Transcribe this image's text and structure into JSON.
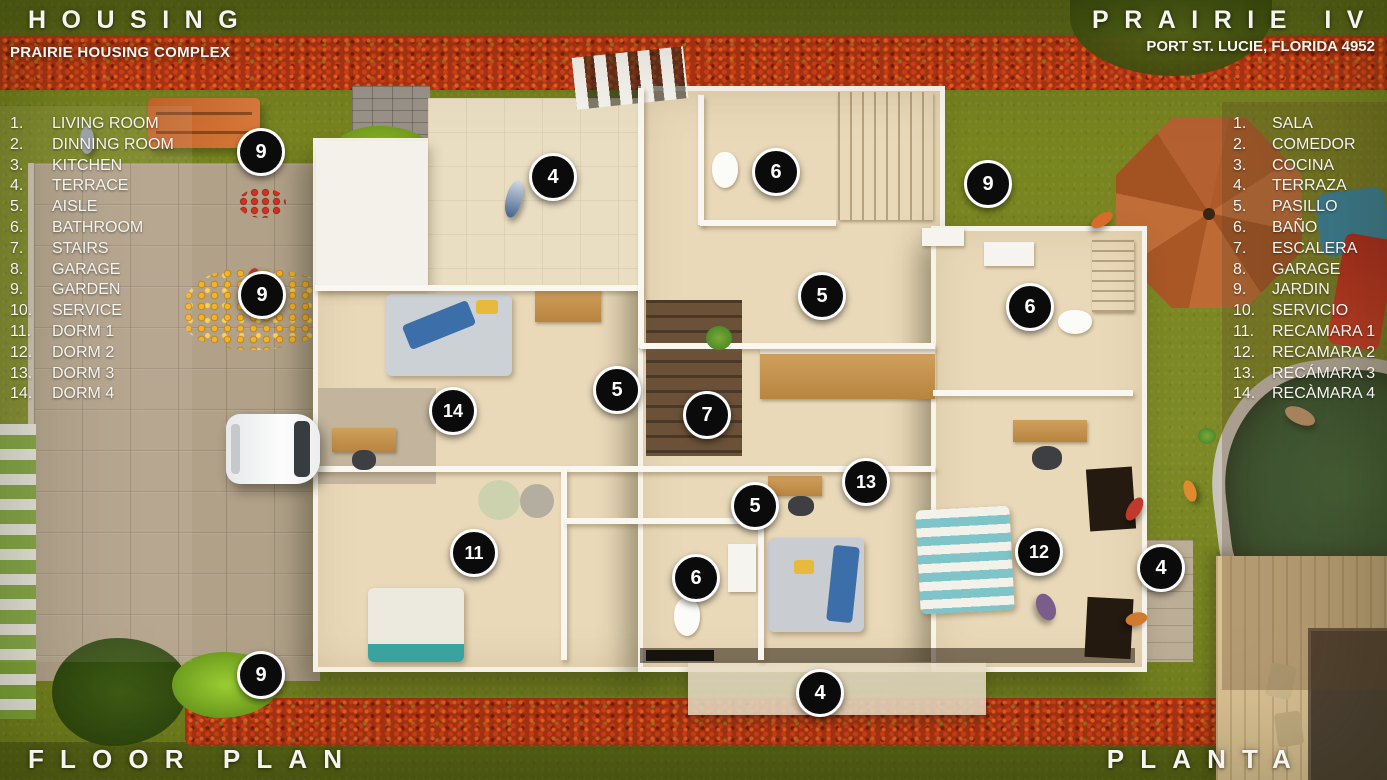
{
  "header": {
    "title_left": "HOUSING",
    "subtitle_left": "PRAIRIE HOUSING COMPLEX",
    "title_right": "PRAIRIE IV",
    "subtitle_right": "PORT ST. LUCIE, FLORIDA 4952"
  },
  "footer": {
    "label_left": "FLOOR PLAN",
    "label_right": "PLANTA"
  },
  "legend_en": {
    "items": [
      {
        "num": "1.",
        "label": "LIVING ROOM"
      },
      {
        "num": "2.",
        "label": "DINNING ROOM"
      },
      {
        "num": "3.",
        "label": "KITCHEN"
      },
      {
        "num": "4.",
        "label": "TERRACE"
      },
      {
        "num": "5.",
        "label": "AISLE"
      },
      {
        "num": "6.",
        "label": "BATHROOM"
      },
      {
        "num": "7.",
        "label": "STAIRS"
      },
      {
        "num": "8.",
        "label": "GARAGE"
      },
      {
        "num": "9.",
        "label": "GARDEN"
      },
      {
        "num": "10.",
        "label": "SERVICE"
      },
      {
        "num": "11.",
        "label": "DORM 1"
      },
      {
        "num": "12.",
        "label": "DORM 2"
      },
      {
        "num": "13.",
        "label": "DORM 3"
      },
      {
        "num": "14.",
        "label": "DORM 4"
      }
    ]
  },
  "legend_es": {
    "items": [
      {
        "num": "1.",
        "label": "SALA"
      },
      {
        "num": "2.",
        "label": "COMEDOR"
      },
      {
        "num": "3.",
        "label": "COCINA"
      },
      {
        "num": "4.",
        "label": "TERRAZA"
      },
      {
        "num": "5.",
        "label": "PASILLO"
      },
      {
        "num": "6.",
        "label": "BAÑO"
      },
      {
        "num": "7.",
        "label": "ESCALERA"
      },
      {
        "num": "8.",
        "label": "GARAGE"
      },
      {
        "num": "9.",
        "label": "JARDIN"
      },
      {
        "num": "10.",
        "label": "SERVICIO"
      },
      {
        "num": "11.",
        "label": "RECAMARA 1"
      },
      {
        "num": "12.",
        "label": "RECAMARA 2"
      },
      {
        "num": "13.",
        "label": "RECÁMARA 3"
      },
      {
        "num": "14.",
        "label": "RECÀMARA 4"
      }
    ]
  },
  "badges": [
    {
      "label": "9",
      "x": 261,
      "y": 152
    },
    {
      "label": "4",
      "x": 553,
      "y": 177
    },
    {
      "label": "6",
      "x": 776,
      "y": 172
    },
    {
      "label": "9",
      "x": 988,
      "y": 184
    },
    {
      "label": "9",
      "x": 262,
      "y": 295
    },
    {
      "label": "5",
      "x": 822,
      "y": 296
    },
    {
      "label": "6",
      "x": 1030,
      "y": 307
    },
    {
      "label": "5",
      "x": 617,
      "y": 390
    },
    {
      "label": "14",
      "x": 453,
      "y": 411
    },
    {
      "label": "7",
      "x": 707,
      "y": 415
    },
    {
      "label": "13",
      "x": 866,
      "y": 482
    },
    {
      "label": "5",
      "x": 755,
      "y": 506
    },
    {
      "label": "11",
      "x": 474,
      "y": 553
    },
    {
      "label": "12",
      "x": 1039,
      "y": 552
    },
    {
      "label": "4",
      "x": 1161,
      "y": 568
    },
    {
      "label": "6",
      "x": 696,
      "y": 578
    },
    {
      "label": "9",
      "x": 261,
      "y": 675
    },
    {
      "label": "4",
      "x": 820,
      "y": 693
    }
  ],
  "colors": {
    "badge_bg": "#0b0b0b",
    "badge_border": "#fdfdfd",
    "grass": "#78851f",
    "hedge": "#a93413",
    "floor": "#e9d9b9",
    "pool_water": "#2c5530",
    "gazebo": "#b4612e",
    "text": "#f5f4ef"
  }
}
